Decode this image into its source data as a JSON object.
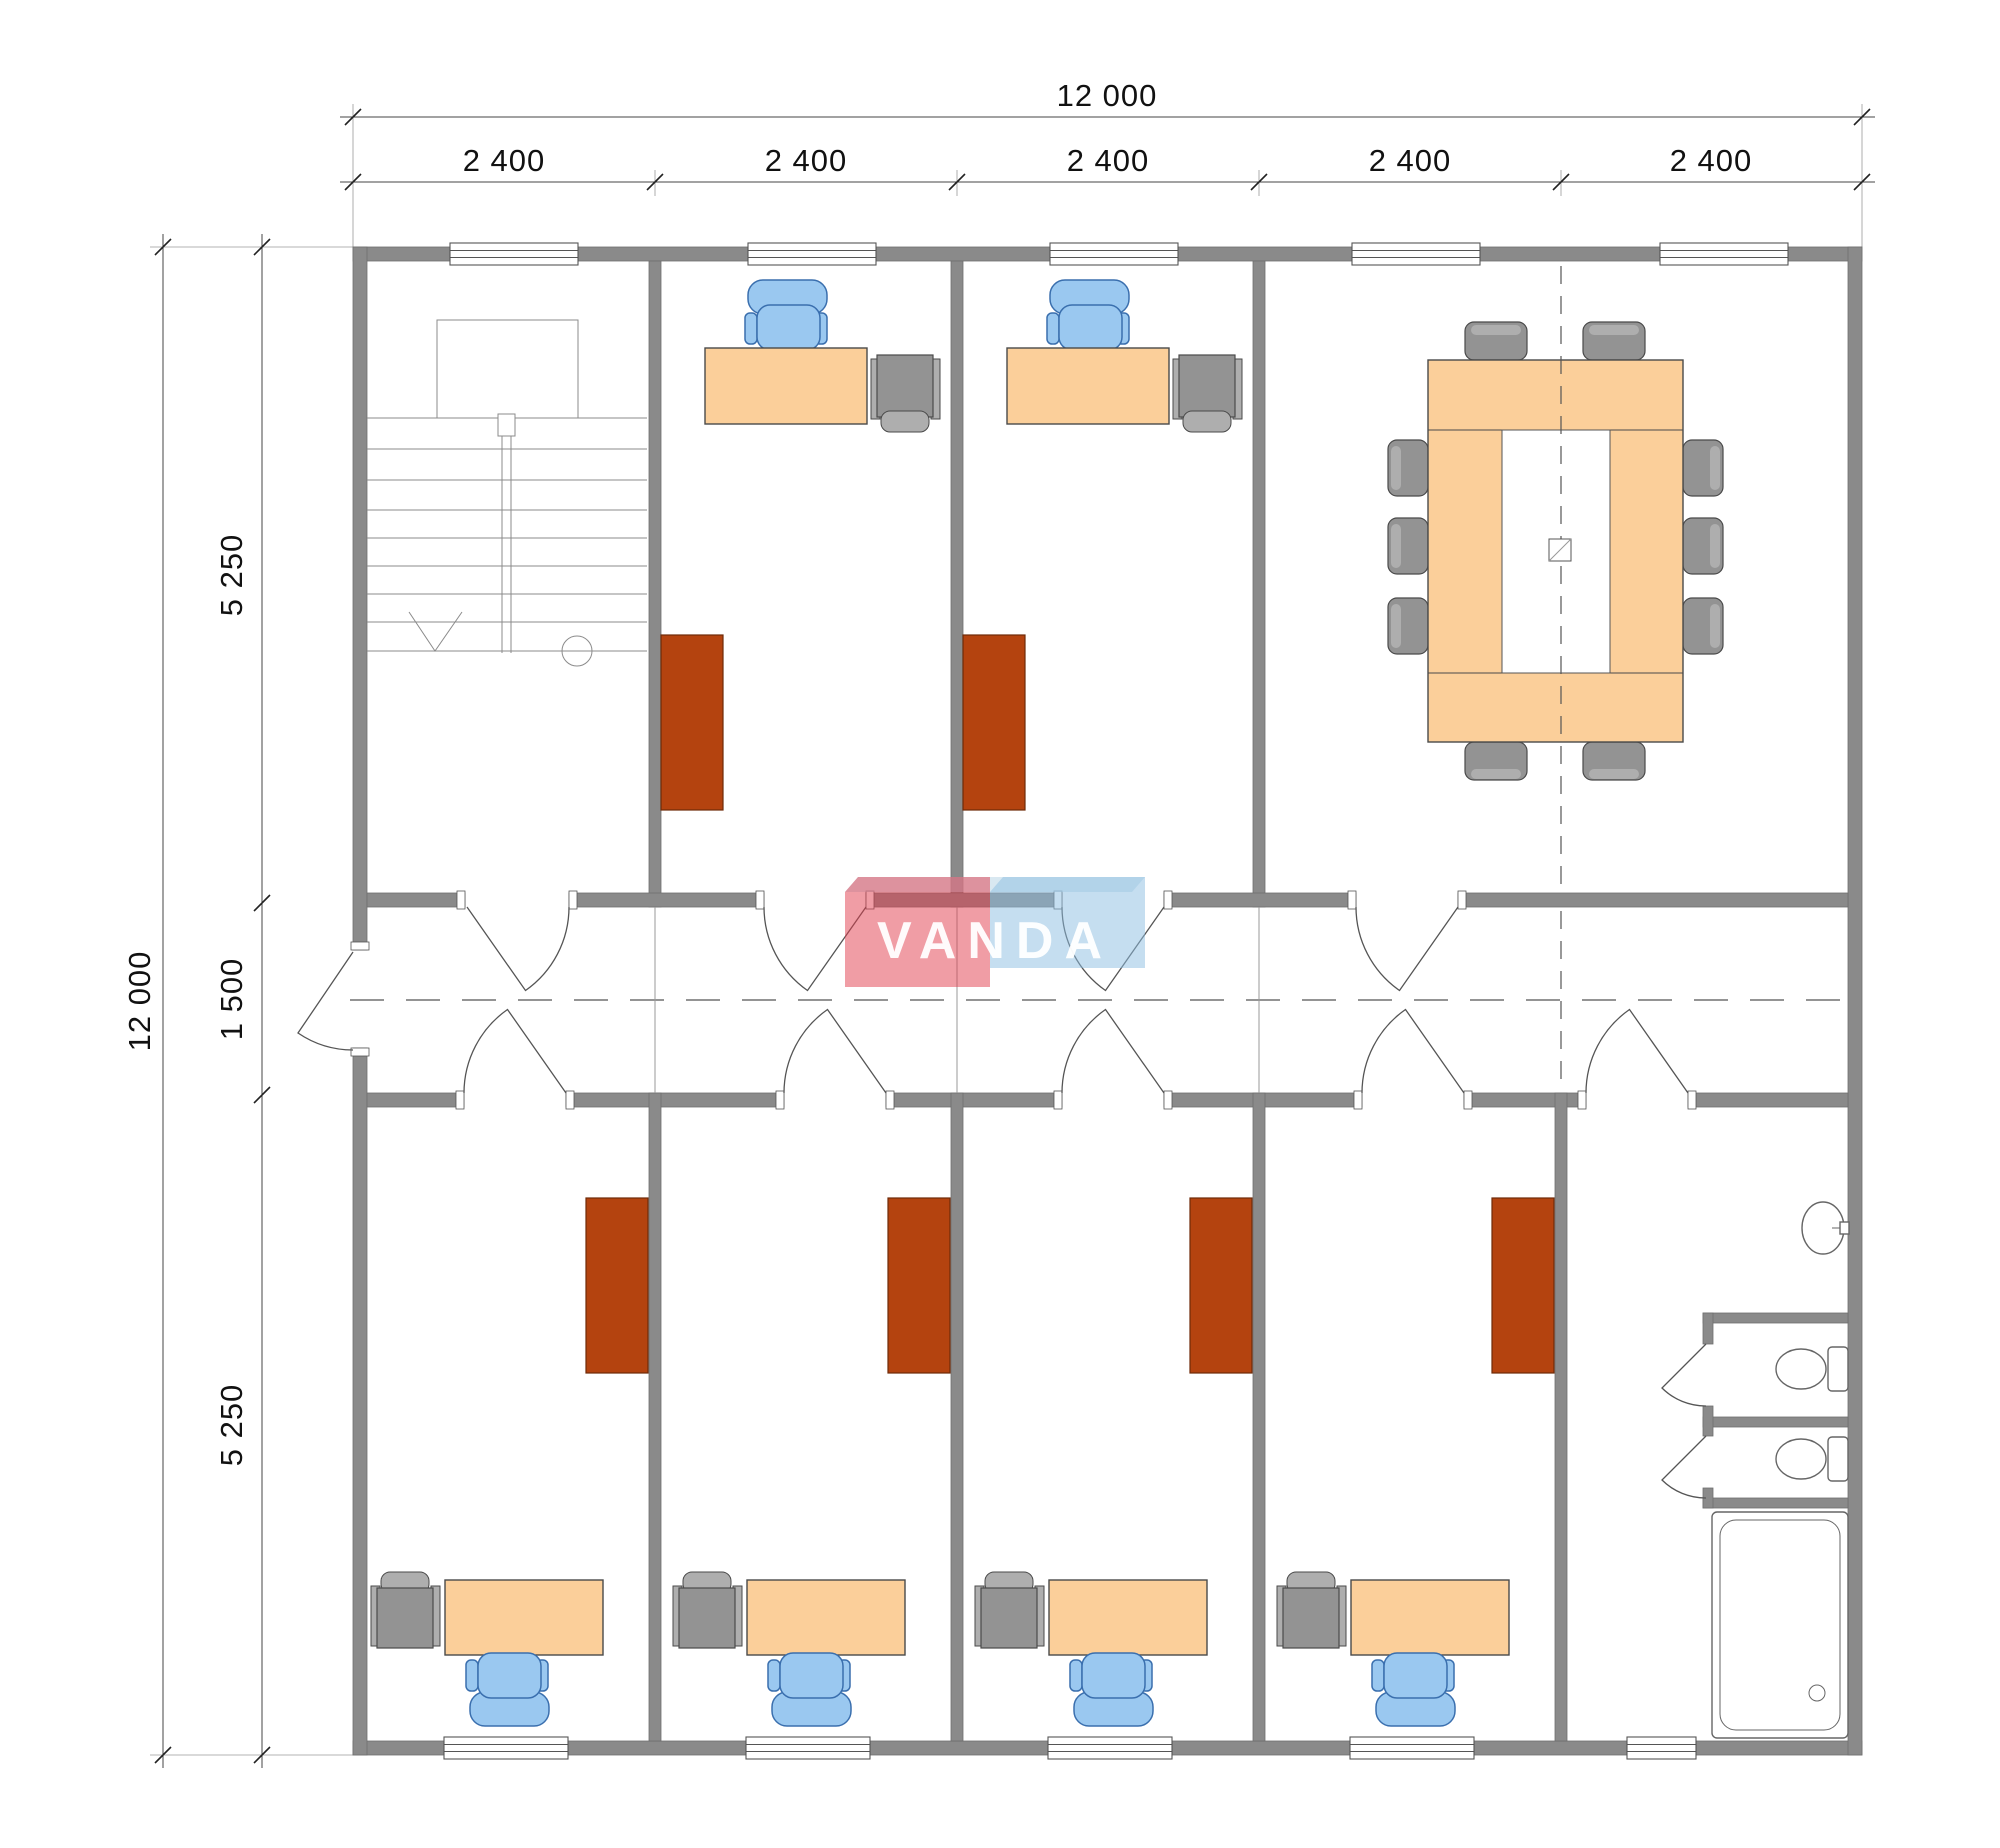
{
  "title": "Office floor plan drawing",
  "logo": {
    "text": "VANDA"
  },
  "dimensions": {
    "top_total": "12 000",
    "top_bays": [
      "2 400",
      "2 400",
      "2 400",
      "2 400",
      "2 400"
    ],
    "left_total": "12 000",
    "left_segments": [
      "5 250",
      "1 500",
      "5 250"
    ]
  },
  "colors": {
    "wall": "#8a8a8a",
    "desk": "#FBCF9A",
    "deskStroke": "#4a4a4a",
    "chair": "#9AC8F0",
    "chairStroke": "#3A6FAE",
    "cabinet": "#B4430F",
    "cabinetStroke": "#6E2A08",
    "equip": "#939393",
    "equipLight": "#AEAEAE",
    "equipStroke": "#4a4a4a",
    "fixture": "#ffffff",
    "fixtureStroke": "#666666",
    "dimLine": "#444444",
    "dimText": "#111111",
    "logoRed": "#E23C4B",
    "logoBlue": "#8CBEE1",
    "logoTop": "#BFD8E8"
  }
}
